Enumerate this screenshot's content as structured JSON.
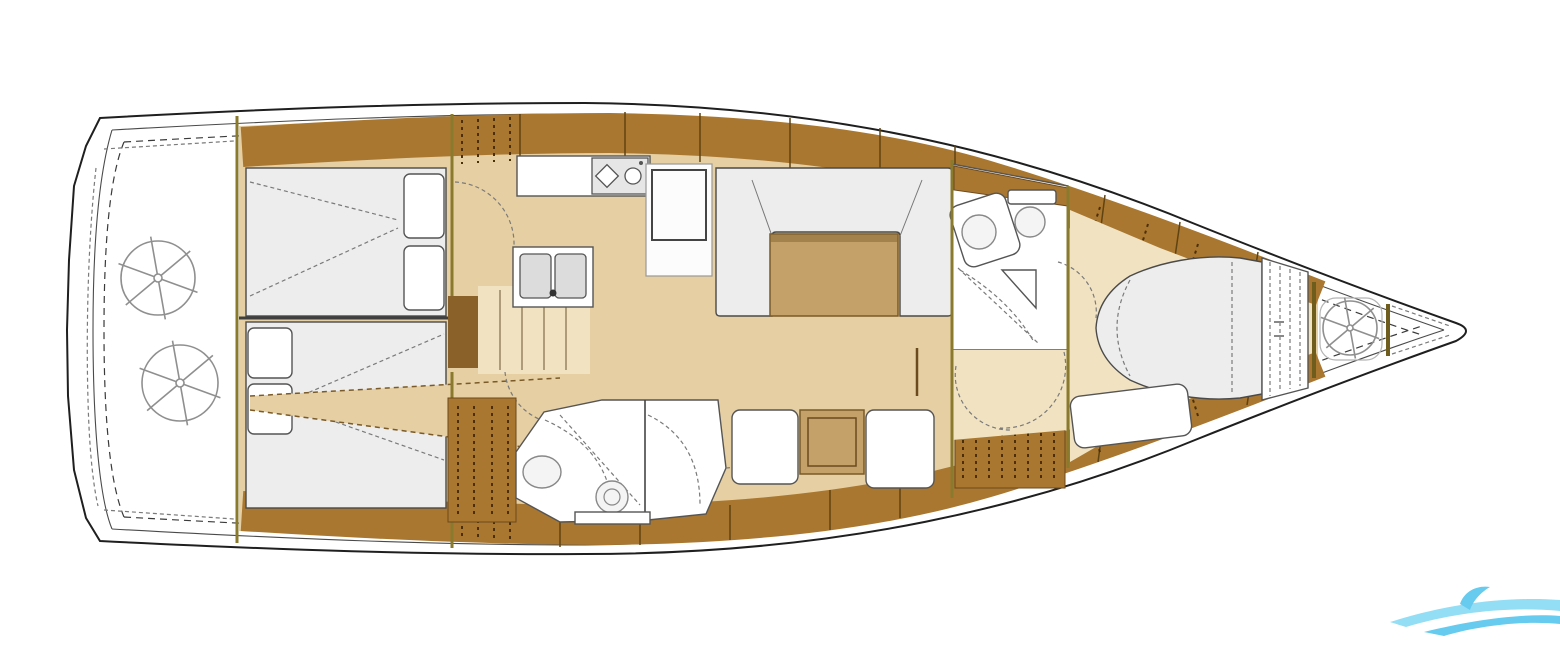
{
  "colors": {
    "paper": "#ffffff",
    "line": "#1f1f1f",
    "floor": "#e6cfa2",
    "floor_light": "#f1e3c2",
    "wood": "#a9772f",
    "wood_dark": "#8a6128",
    "wood_edge": "#5f4313",
    "wood_tick": "#4a2f08",
    "table": "#c3a169",
    "cushion": "#ededee",
    "sketch": "#8f8f8f",
    "bulkhead": "#8a7a2e",
    "watermark_light": "#8edcf5",
    "watermark_mid": "#5ec9ee"
  },
  "diagram": {
    "type": "yacht-interior-floor-plan",
    "orientation": "bow-right"
  },
  "regions": {
    "hull": "hull-outline",
    "cockpit": "stern-cockpit",
    "wheel_port": "helm-wheel-port",
    "wheel_stbd": "helm-wheel-starboard",
    "cabin_port": "aft-cabin-port",
    "cabin_stbd": "aft-cabin-starboard",
    "stairs": "companionway-stairs",
    "galley": "galley",
    "stove": "stove-two-burner",
    "sink": "double-sink",
    "fridge": "refrigerator",
    "settee": "saloon-settee",
    "table": "saloon-table",
    "aft_head": "aft-head-bathroom",
    "toilet": "toilet",
    "basin": "washbasin",
    "nav": "nav-seat-and-chart-table",
    "fwd_head": "forward-head-bathroom",
    "fwd_cabin": "forward-cabin",
    "berth": "island-double-berth",
    "bow_locker": "bow-sail-locker",
    "coil": "anchor-rope-coil",
    "watermark": "wave-watermark-logo"
  }
}
